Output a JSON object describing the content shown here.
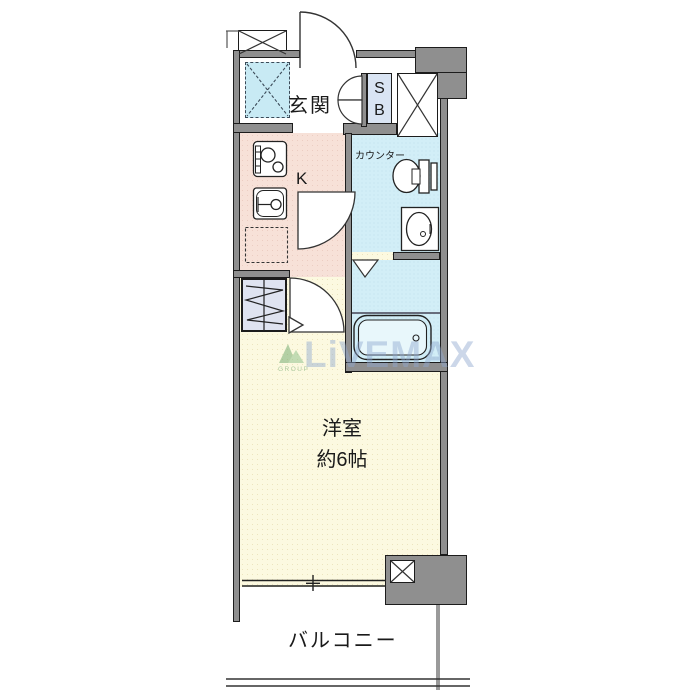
{
  "plan_title": "1K apartment floor plan",
  "rooms": {
    "entrance": {
      "label": "玄関"
    },
    "kitchen": {
      "label": "K"
    },
    "shoe_box": {
      "line1": "S",
      "line2": "B"
    },
    "washroom": {
      "counter_label": "カウンター"
    },
    "western_room": {
      "name": "洋室",
      "size": "約6帖"
    },
    "balcony": {
      "label": "バルコニー"
    }
  },
  "watermark": {
    "brand": "LiVEMAX",
    "group": "GROUP"
  },
  "colors": {
    "wall": "#8f8f8f",
    "kitchen_floor": "#f7e1d8",
    "water_floor": "#d2eef7",
    "room_floor": "#fcf9e0",
    "closet_floor": "#dfe3f0",
    "shoe_box_fill": "#d9e4f3",
    "tile_fill": "#c8eaf4",
    "watermark_blue": "#8fa8cf",
    "logo_green": "#6fae6f"
  }
}
